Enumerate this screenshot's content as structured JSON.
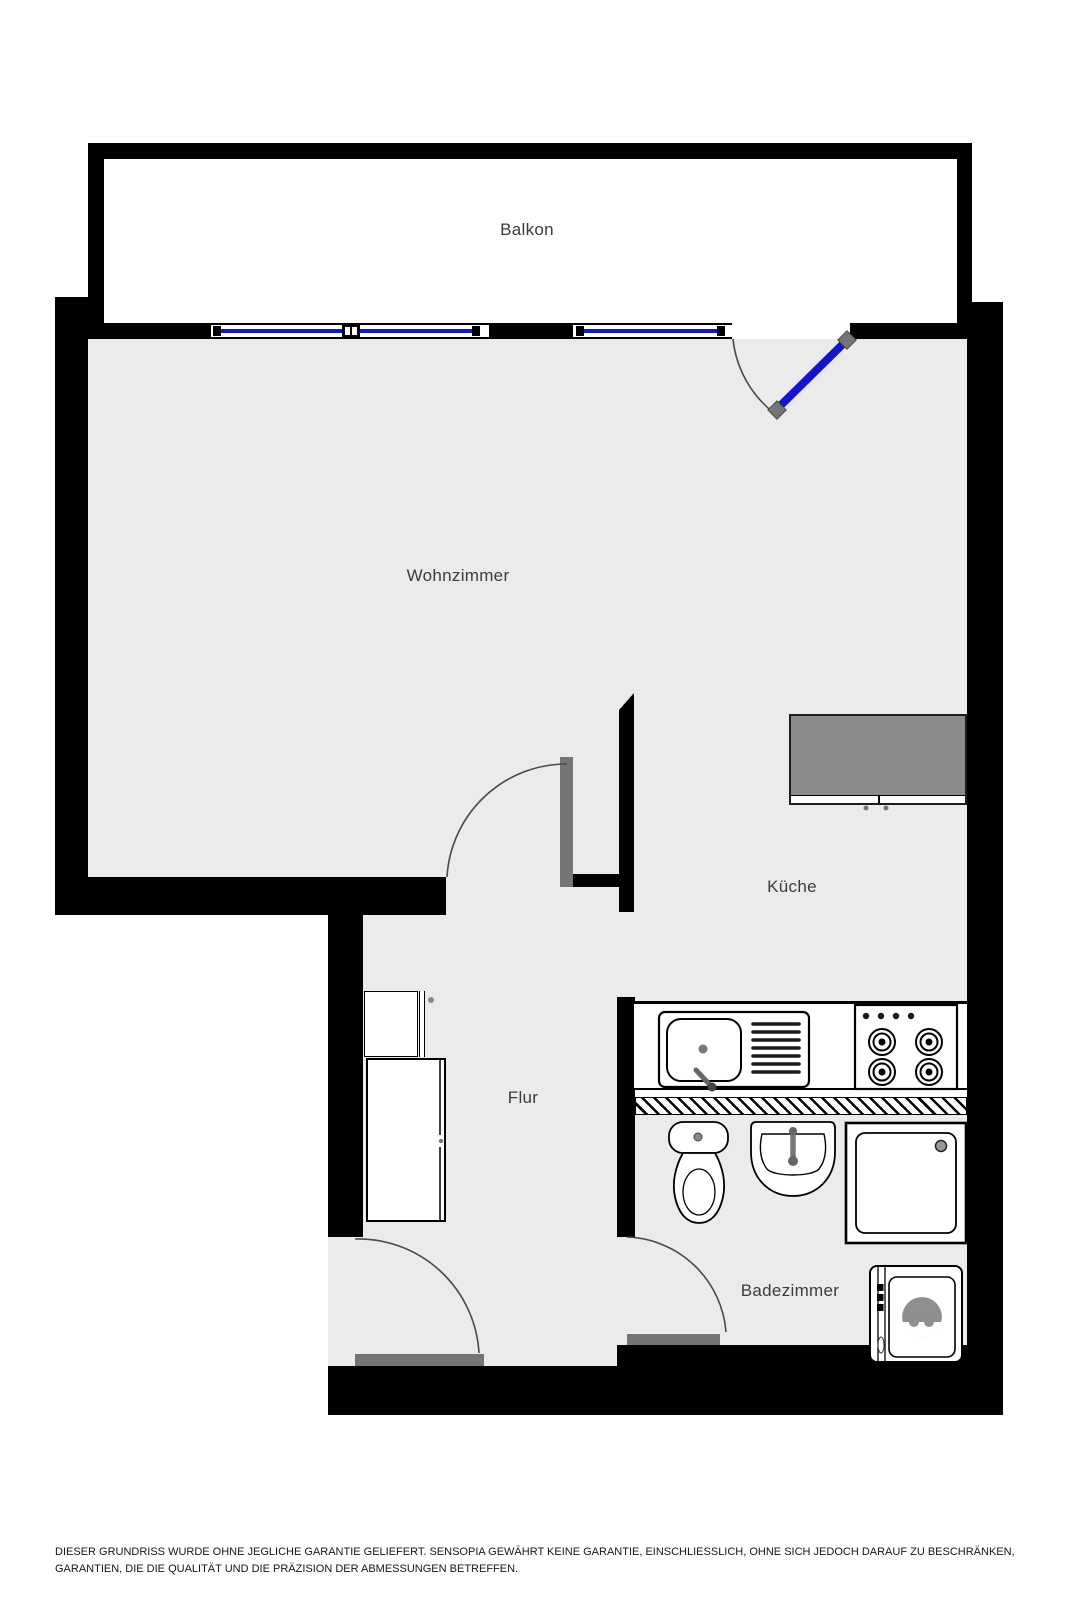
{
  "document": {
    "kind": "apartment-floor-plan",
    "language": "de"
  },
  "rooms": [
    {
      "id": "balkon",
      "label": "Balkon"
    },
    {
      "id": "wohnzimmer",
      "label": "Wohnzimmer"
    },
    {
      "id": "kueche",
      "label": "Küche"
    },
    {
      "id": "flur",
      "label": "Flur"
    },
    {
      "id": "badezimmer",
      "label": "Badezimmer"
    }
  ],
  "fixtures": [
    "balcony-window",
    "balcony-door",
    "kitchen-counter",
    "kitchen-sink",
    "stove",
    "sideboard",
    "wardrobe-small",
    "wardrobe-large",
    "toilet",
    "bathroom-sink",
    "shower",
    "washing-machine",
    "interior-doors"
  ],
  "colors": {
    "wall": "#000000",
    "floor": "#ebebeb",
    "window_blue": "#1414cf",
    "door_leaf_gray": "#757575",
    "furniture_gray": "#8a8a8a"
  },
  "disclaimer": "DIESER GRUNDRISS WURDE OHNE JEGLICHE GARANTIE GELIEFERT. SENSOPIA GEWÄHRT KEINE GARANTIE, EINSCHLIESSLICH, OHNE SICH JEDOCH DARAUF ZU BESCHRÄNKEN, GARANTIEN, DIE DIE QUALITÄT UND DIE PRÄZISION DER ABMESSUNGEN BETREFFEN."
}
